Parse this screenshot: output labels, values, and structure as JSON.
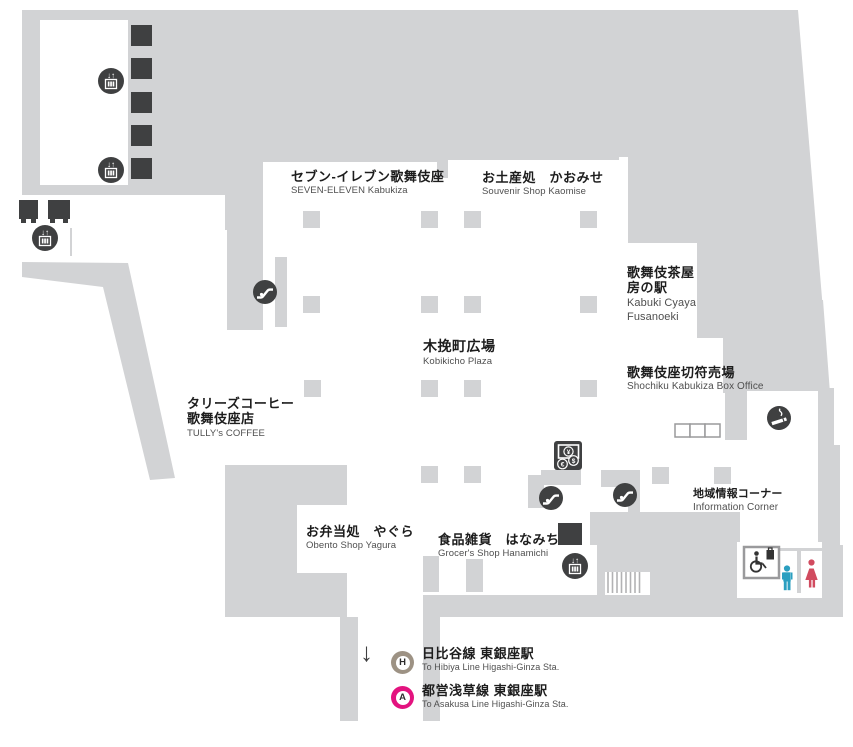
{
  "areas": {
    "plaza": {
      "jp": "木挽町広場",
      "en": "Kobikicho Plaza"
    },
    "seven_eleven": {
      "jp": "セブン-イレブン歌舞伎座",
      "en": "SEVEN-ELEVEN Kabukiza"
    },
    "souvenir": {
      "jp": "お土産処　かおみせ",
      "en": "Souvenir Shop Kaomise"
    },
    "chaya": {
      "jp_line1": "歌舞伎茶屋",
      "jp_line2": "房の駅",
      "en_line1": "Kabuki Cyaya",
      "en_line2": "Fusanoeki"
    },
    "box_office": {
      "jp": "歌舞伎座切符売場",
      "en": "Shochiku Kabukiza Box Office"
    },
    "tullys": {
      "jp_line1": "タリーズコーヒー",
      "jp_line2": "歌舞伎座店",
      "en": "TULLY's COFFEE"
    },
    "obento": {
      "jp": "お弁当処　やぐら",
      "en": "Obento Shop Yagura"
    },
    "grocer": {
      "jp": "食品雑貨　はなみち",
      "en": "Grocer's Shop Hanamichi"
    },
    "info_corner": {
      "jp": "地域情報コーナー",
      "en": "Information Corner"
    }
  },
  "stations": {
    "hibiya": {
      "badge": "H",
      "jp": "日比谷線 東銀座駅",
      "en": "To Hibiya Line Higashi-Ginza Sta."
    },
    "asakusa": {
      "badge": "A",
      "jp": "都営浅草線 東銀座駅",
      "en": "To Asakusa Line Higashi-Ginza Sta."
    }
  },
  "glyphs": {
    "down_arrow": "↓",
    "elevator_arrows": "↓↑",
    "yen": "¥",
    "dollar": "$",
    "euro": "€"
  },
  "icons": [
    "elevator-icon",
    "escalator-icon",
    "smoking-area-icon",
    "currency-exchange-icon",
    "stairs-icon",
    "accessible-restroom-icon",
    "mens-restroom-icon",
    "womens-restroom-icon",
    "down-arrow-icon",
    "hibiya-line-badge",
    "asakusa-line-badge"
  ],
  "colors": {
    "floor_gray": "#d2d3d5",
    "dark": "#3f4041",
    "hibiya_line": "#9d9284",
    "asakusa_line": "#e3137f",
    "male_figure": "#2b9fc0",
    "female_figure": "#d14b5f"
  }
}
